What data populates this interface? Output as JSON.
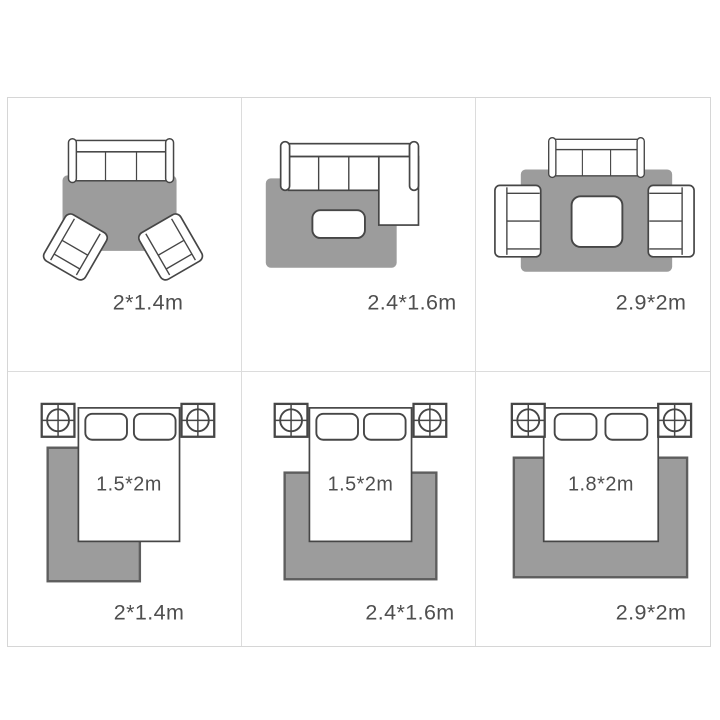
{
  "colors": {
    "background": "#ffffff",
    "frame_border": "#d6d6d6",
    "grid_line": "#dcdcdc",
    "rug": "#9c9c9c",
    "rug_outline": "#5e5e5e",
    "furniture_outline": "#464646",
    "furniture_fill": "#ffffff",
    "label": "#4f4f4f"
  },
  "panels": [
    {
      "scene": "living-room-sofa-two-armchairs",
      "rug_size": "2*1.4m"
    },
    {
      "scene": "living-room-sectional-sofa",
      "rug_size": "2.4*1.6m"
    },
    {
      "scene": "living-room-sofa-two-loveseats",
      "rug_size": "2.9*2m"
    },
    {
      "scene": "bedroom-offset-rug",
      "rug_size": "2*1.4m",
      "bed_size": "1.5*2m"
    },
    {
      "scene": "bedroom-centered-rug",
      "rug_size": "2.4*1.6m",
      "bed_size": "1.5*2m"
    },
    {
      "scene": "bedroom-wide-rug",
      "rug_size": "2.9*2m",
      "bed_size": "1.8*2m"
    }
  ]
}
